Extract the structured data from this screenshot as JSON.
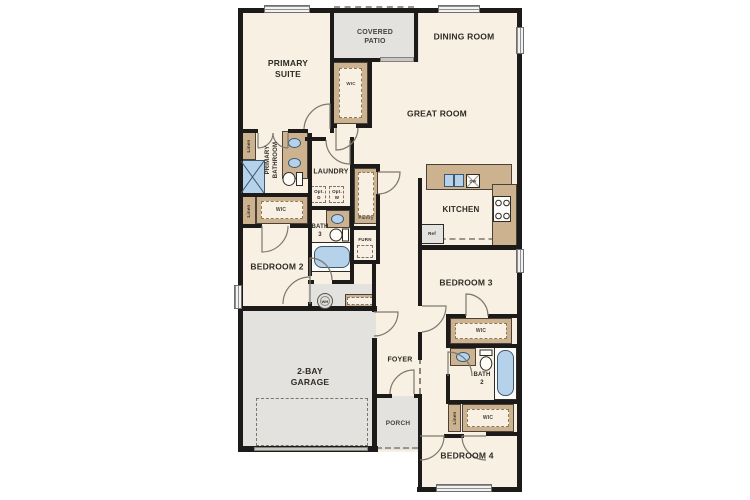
{
  "plan_type": "single-story floor plan",
  "colors": {
    "floor": "#f8f1e3",
    "outdoor_concrete": "#e3e2de",
    "wall": "#1d1b19",
    "cabinet_tan": "#ccb28f",
    "fixture_blue": "#b5d2ea",
    "label_text": "#2f2b26"
  },
  "labels": {
    "covered_patio": "COVERED\nPATIO",
    "dining_room": "DINING ROOM",
    "primary_suite": "PRIMARY\nSUITE",
    "great_room": "GREAT ROOM",
    "kitchen": "KITCHEN",
    "laundry": "LAUNDRY",
    "primary_bathroom": "PRIMARY\nBATHROOM",
    "bedroom_2": "BEDROOM 2",
    "bedroom_3": "BEDROOM 3",
    "bedroom_4": "BEDROOM 4",
    "bath_2": "BATH\n2",
    "bath_3": "BATH\n3",
    "foyer": "FOYER",
    "porch": "PORCH",
    "garage": "2-BAY\nGARAGE",
    "wic": "WIC",
    "linen": "Linen",
    "pantry": "Pantry",
    "furn": "FURN",
    "opt_d": "Opt.\nD",
    "opt_w": "Opt.\nW",
    "ref": "Ref",
    "dw": "DW",
    "wh": "WH"
  }
}
